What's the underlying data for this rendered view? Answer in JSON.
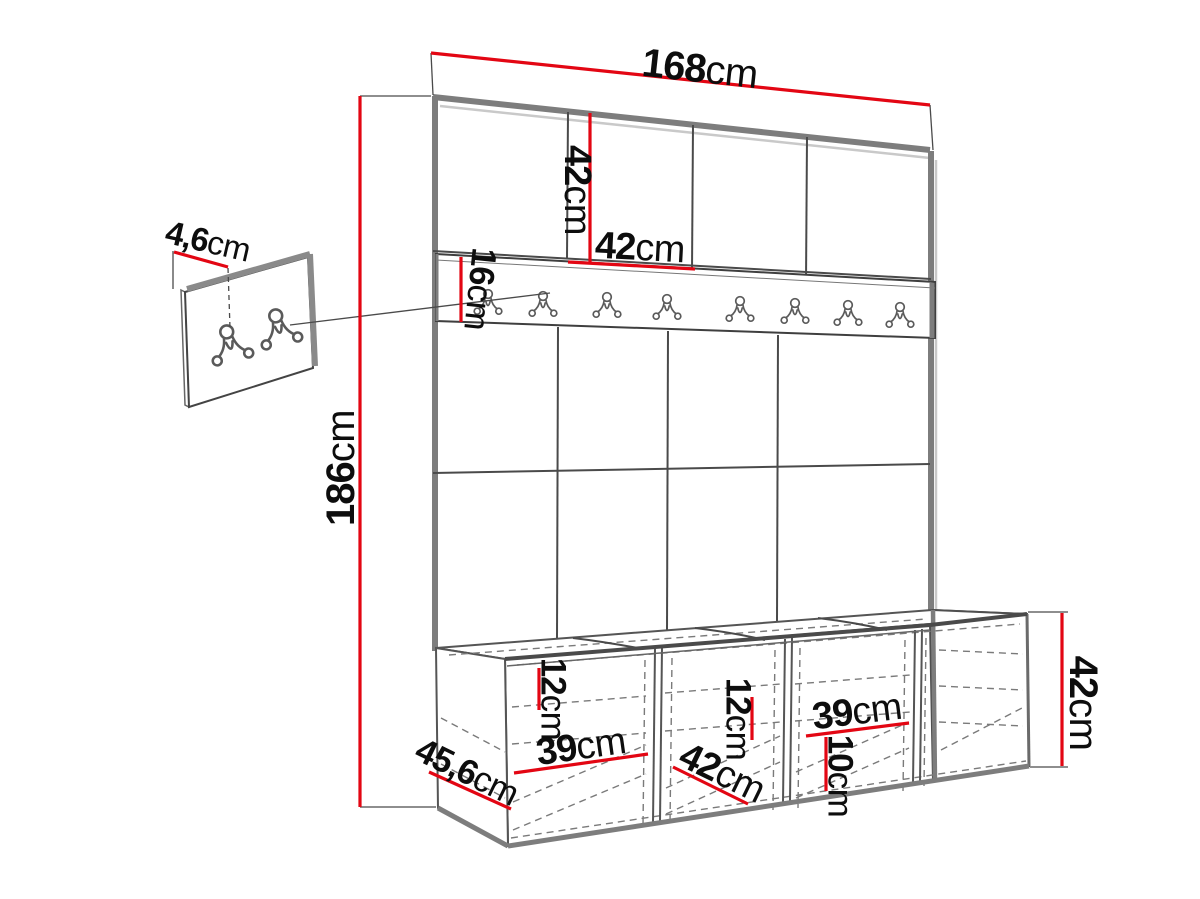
{
  "colors": {
    "dimension_red": "#e30613",
    "drawing_line": "#4f4f4f",
    "edge_gray": "#7d7d7d",
    "shadow_gray": "#c9c9c9",
    "dash_gray": "#7a7a7a",
    "text_black": "#0d0d0d",
    "background": "#ffffff"
  },
  "labels": {
    "total_width": {
      "value": "168",
      "unit": "cm"
    },
    "upper_panel_height": {
      "value": "42",
      "unit": "cm"
    },
    "panel_width": {
      "value": "42",
      "unit": "cm"
    },
    "rail_height": {
      "value": "16",
      "unit": "cm"
    },
    "total_height": {
      "value": "186",
      "unit": "cm"
    },
    "small_panel_depth": {
      "value": "4,6",
      "unit": "cm"
    },
    "bench_top_gap": {
      "value": "12",
      "unit": "cm"
    },
    "bench_inner_width_1": {
      "value": "39",
      "unit": "cm"
    },
    "bench_depth": {
      "value": "45,6",
      "unit": "cm"
    },
    "bench_door_width": {
      "value": "42",
      "unit": "cm"
    },
    "bench_mid_gap": {
      "value": "12",
      "unit": "cm"
    },
    "bench_inner_width_2": {
      "value": "39",
      "unit": "cm"
    },
    "bench_plinth_height": {
      "value": "10",
      "unit": "cm"
    },
    "bench_height": {
      "value": "42",
      "unit": "cm"
    }
  },
  "counts": {
    "rail_hooks": 8,
    "small_panel_hooks": 2,
    "upper_panel_squares": 4,
    "lower_panel_squares": 8,
    "bench_compartments": 4
  }
}
